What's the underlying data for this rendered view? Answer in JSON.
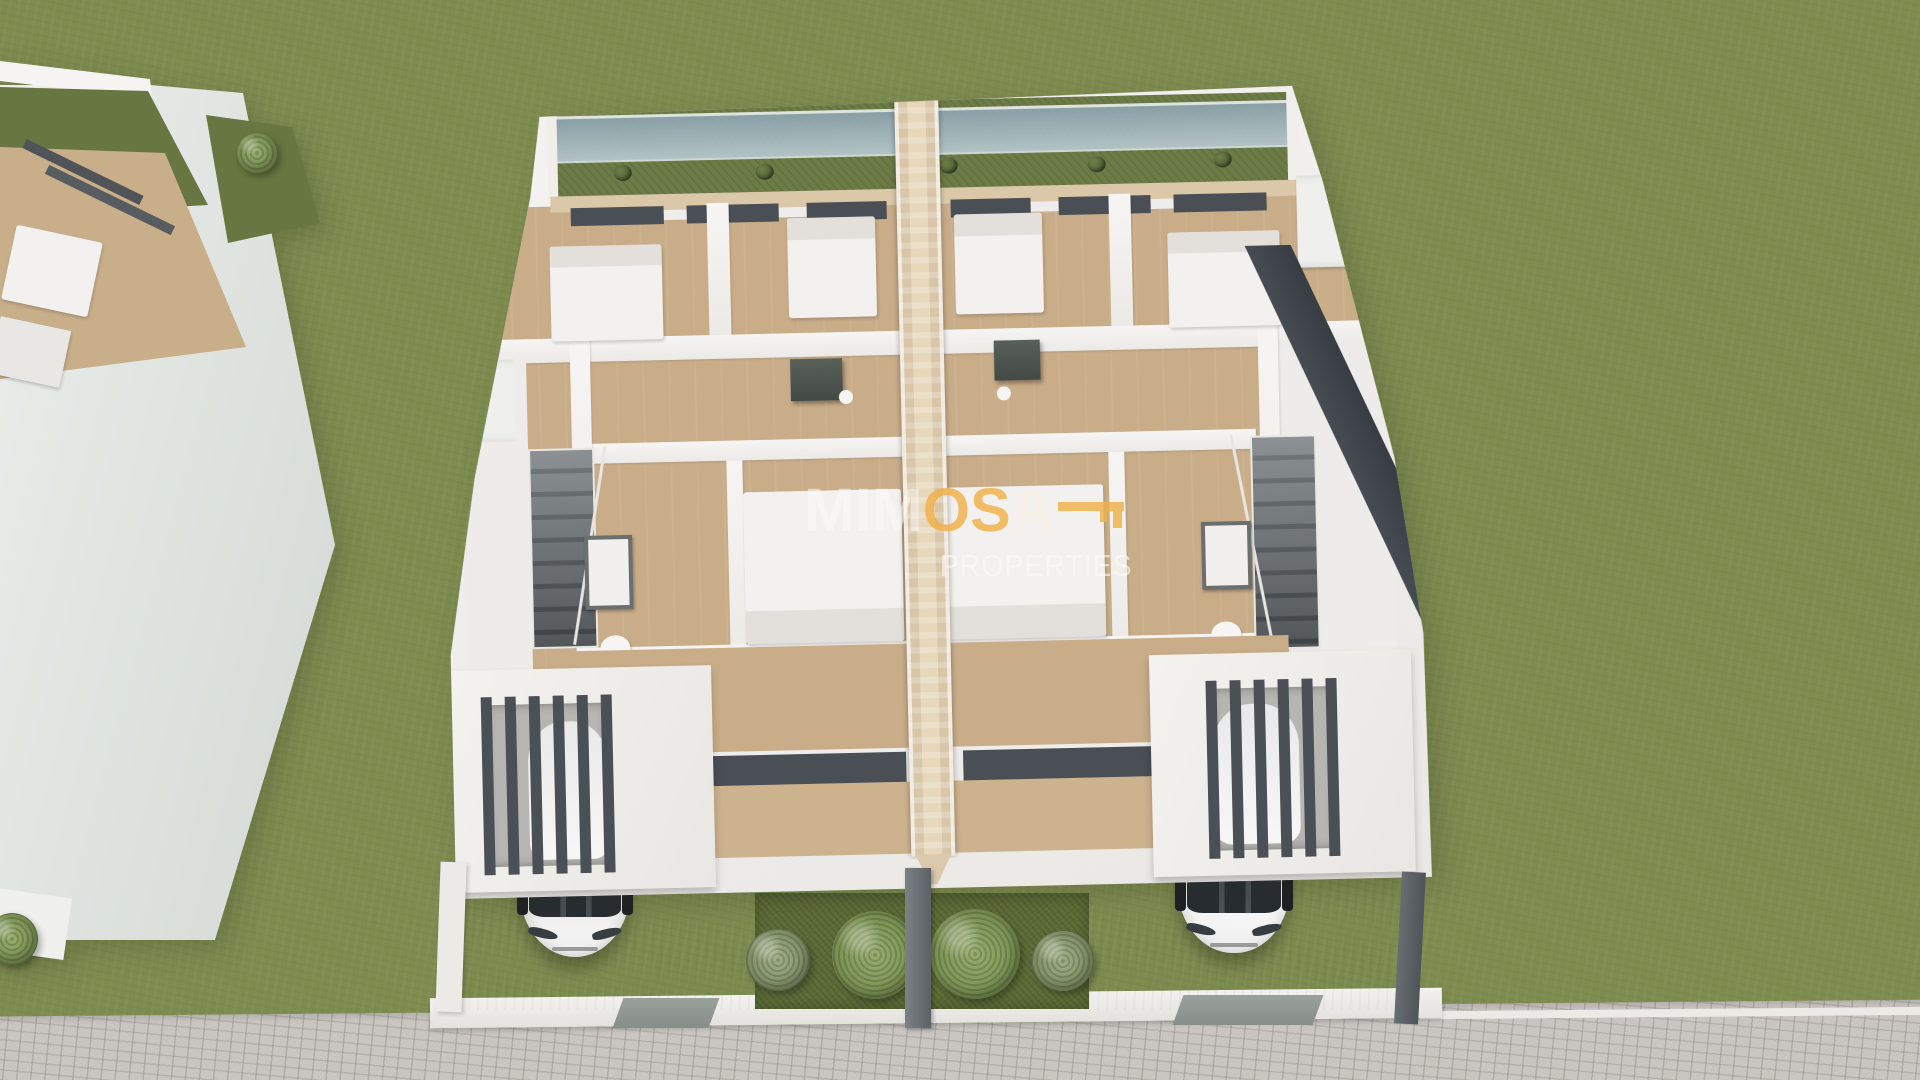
{
  "watermark": {
    "brand": {
      "white_part": "MIM",
      "orange_part": "OS",
      "tail_part": "A"
    },
    "subtitle": "PROPERTIES"
  },
  "palette": {
    "grass": "#7e8b4f",
    "rear_garden_green": "#687741",
    "floor_tan": "#c9ad89",
    "wall_white": "#f3f1ef",
    "frame_charcoal": "#4a4f55",
    "party_wall_beige": "#d9c6a8",
    "glass_blue": "#a3b8c4",
    "driveway_gray": "#d6d4d0",
    "sidewalk_gray": "#c9c6c1",
    "garden_bed_green": "#5d6c37",
    "brand_orange": "#f0b048",
    "car_white": "#f2f2f2"
  }
}
